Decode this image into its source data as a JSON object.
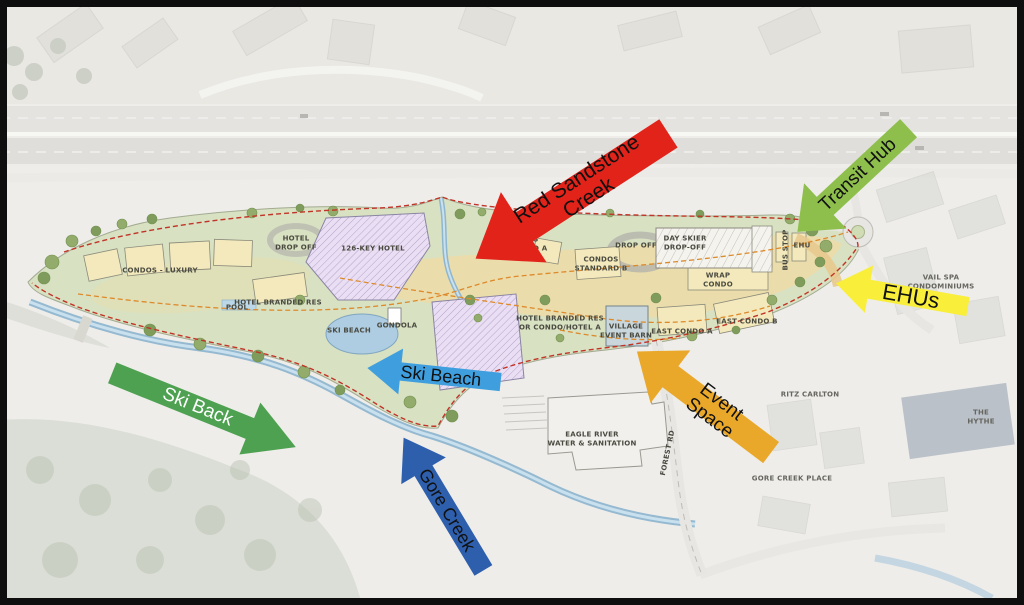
{
  "annotations": {
    "arrows": [
      {
        "id": "red-sandstone-creek",
        "label": "Red Sandstone Creek",
        "direction": "down-left",
        "color": "#e2231a",
        "text_color": "#000000"
      },
      {
        "id": "transit-hub",
        "label": "Transit Hub",
        "direction": "down-left",
        "color": "#8ebf4c",
        "text_color": "#1a1a1a"
      },
      {
        "id": "ehus",
        "label": "EHUs",
        "direction": "left",
        "color": "#f9ee3a",
        "text_color": "#1a1a1a"
      },
      {
        "id": "ski-beach",
        "label": "Ski Beach",
        "direction": "left",
        "color": "#3f9edd",
        "text_color": "#000000"
      },
      {
        "id": "event-space",
        "label": "Event Space",
        "direction": "up-left",
        "color": "#eaa82a",
        "text_color": "#1a1a1a"
      },
      {
        "id": "ski-back",
        "label": "Ski Back",
        "direction": "down-right",
        "color": "#4fa152",
        "text_color": "#ffffff"
      },
      {
        "id": "gore-creek",
        "label": "Gore Creek",
        "direction": "up-left",
        "color": "#2e5fad",
        "text_color": "#000000"
      }
    ]
  },
  "plan_labels": [
    {
      "text": "CONDOS - LUXURY"
    },
    {
      "text": "HOTEL\nDROP OFF"
    },
    {
      "text": "126-KEY HOTEL"
    },
    {
      "text": "HOTEL BRANDED RES"
    },
    {
      "text": "POOL"
    },
    {
      "text": "SKI BEACH"
    },
    {
      "text": "GONDOLA"
    },
    {
      "text": "CONDOS\nSTANDARD A"
    },
    {
      "text": "CONDOS\nSTANDARD B"
    },
    {
      "text": "DROP OFF"
    },
    {
      "text": "DAY SKIER\nDROP-OFF"
    },
    {
      "text": "WRAP\nCONDO"
    },
    {
      "text": "BUS STOP"
    },
    {
      "text": "EHU"
    },
    {
      "text": "HOTEL BRANDED RES\nOR CONDO/HOTEL A"
    },
    {
      "text": "VILLAGE\nEVENT BARN"
    },
    {
      "text": "EAST CONDO A"
    },
    {
      "text": "EAST CONDO B"
    },
    {
      "text": "EAGLE RIVER\nWATER & SANITATION"
    },
    {
      "text": "FOREST RD"
    }
  ],
  "context_labels": [
    {
      "text": "VAIL SPA\nCONDOMINIUMS"
    },
    {
      "text": "RITZ CARLTON"
    },
    {
      "text": "THE HYTHE"
    },
    {
      "text": "GORE CREEK PLACE"
    }
  ]
}
